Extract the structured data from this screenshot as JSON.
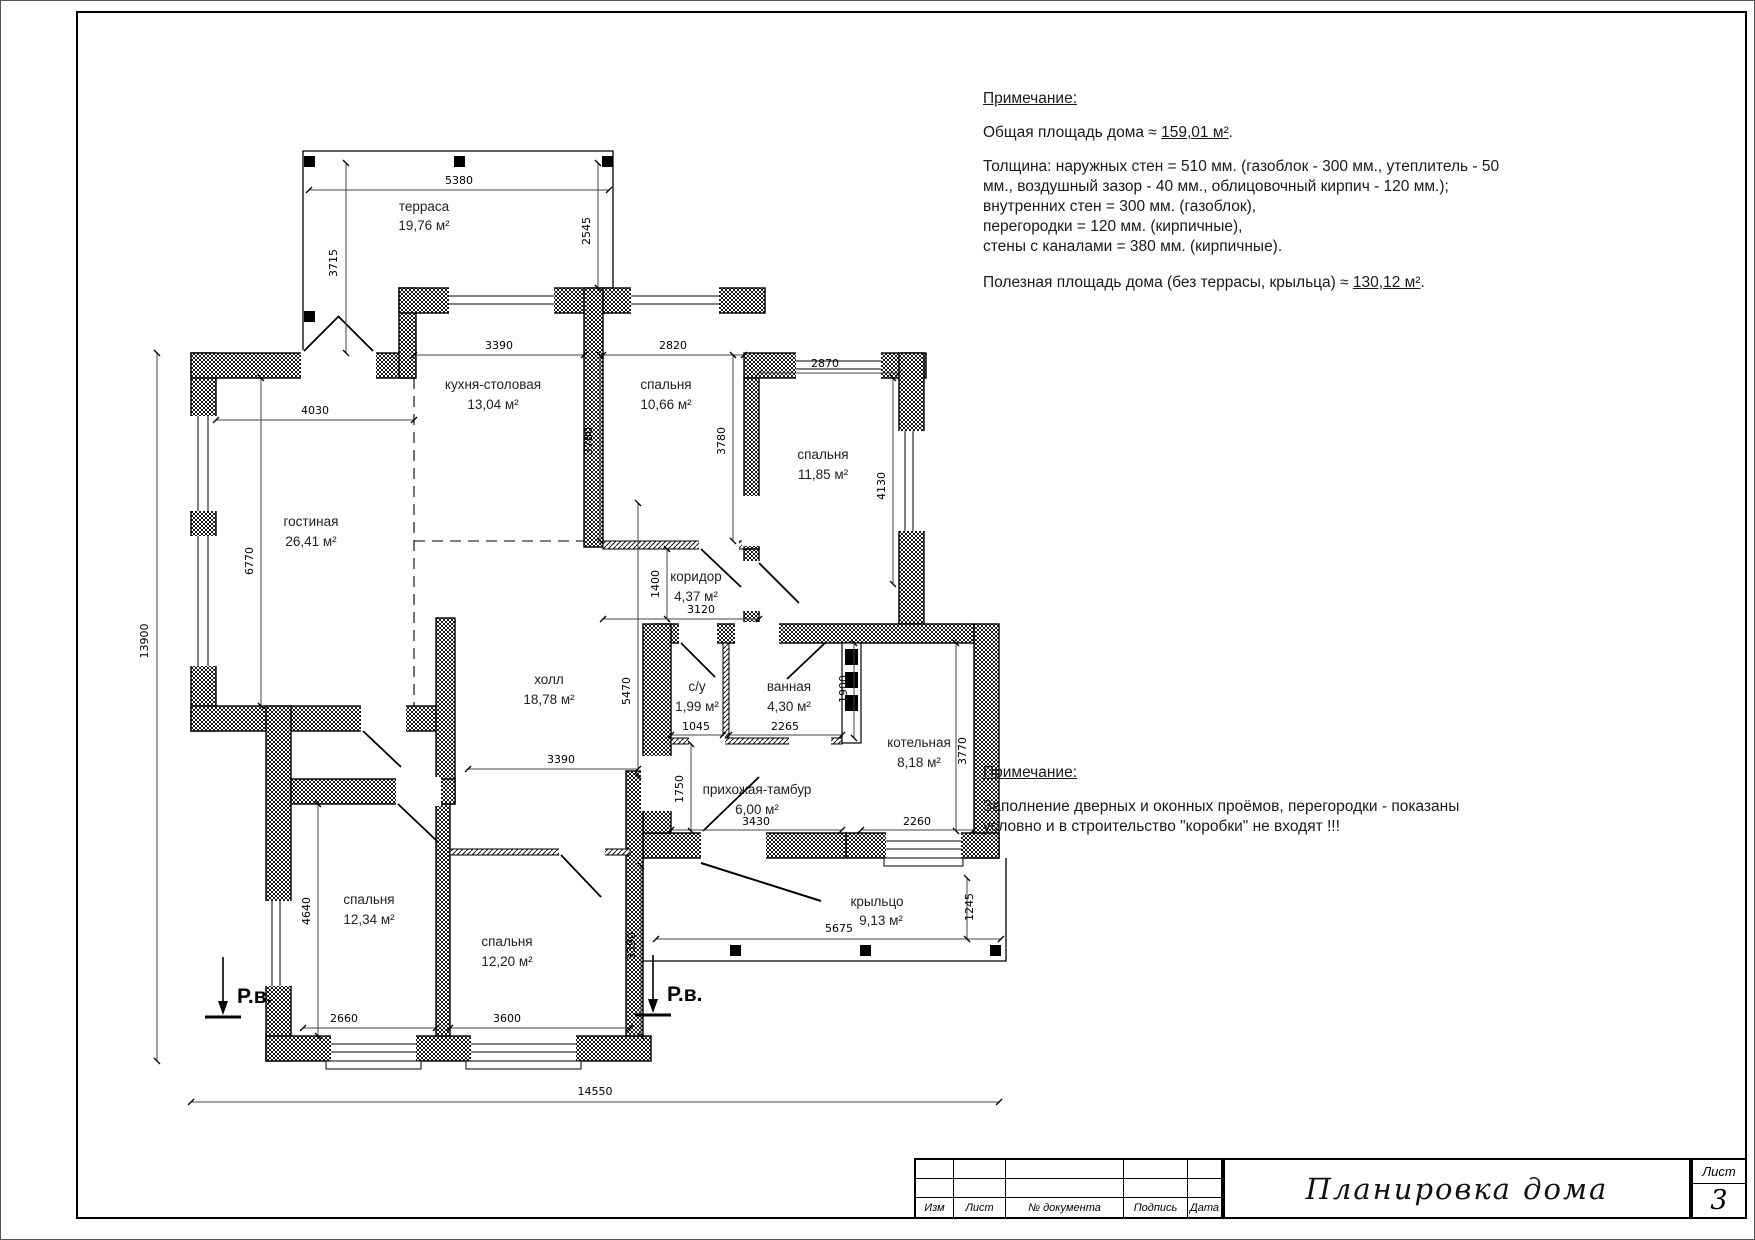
{
  "notes_top": {
    "heading": "Примечание:",
    "total_area_prefix": "Общая площадь дома ≈ ",
    "total_area_value": "159,01 м²",
    "total_area_suffix": ".",
    "thickness_lines": [
      "Толщина: наружных стен = 510 мм. (газоблок - 300 мм., утеплитель - 50",
      "мм., воздушный зазор - 40 мм., облицовочный кирпич - 120 мм.);",
      "внутренних стен = 300 мм. (газоблок),",
      "перегородки = 120 мм. (кирпичные),",
      "стены с каналами = 380 мм. (кирпичные)."
    ],
    "useful_area_prefix": "Полезная площадь дома (без террасы, крыльца) ≈ ",
    "useful_area_value": "130,12 м²",
    "useful_area_suffix": "."
  },
  "notes_mid": {
    "heading": "Примечание:",
    "body_line1": "Заполнение дверных и оконных проёмов, перегородки - показаны",
    "body_line2": "условно и в строительство \"коробки\" не входят  !!!"
  },
  "plan": {
    "rooms": [
      {
        "name": "терраса",
        "area": "19,76 м²"
      },
      {
        "name": "кухня-столовая",
        "area": "13,04 м²"
      },
      {
        "name": "спальня",
        "area": "10,66 м²"
      },
      {
        "name": "спальня",
        "area": "11,85 м²"
      },
      {
        "name": "гостиная",
        "area": "26,41 м²"
      },
      {
        "name": "коридор",
        "area": "4,37 м²"
      },
      {
        "name": "холл",
        "area": "18,78 м²"
      },
      {
        "name": "с/у",
        "area": "1,99 м²"
      },
      {
        "name": "ванная",
        "area": "4,30 м²"
      },
      {
        "name": "котельная",
        "area": "8,18 м²"
      },
      {
        "name": "прихожая-тамбур",
        "area": "6,00 м²"
      },
      {
        "name": "спальня",
        "area": "12,34 м²"
      },
      {
        "name": "спальня",
        "area": "12,20 м²"
      },
      {
        "name": "крыльцо",
        "area": "9,13 м²"
      }
    ],
    "dims": [
      "5380",
      "3715",
      "2545",
      "4030",
      "3390",
      "2820",
      "3780",
      "3780",
      "2870",
      "4130",
      "6770",
      "13900",
      "1400",
      "3120",
      "5470",
      "1045",
      "2265",
      "1900",
      "3770",
      "2260",
      "3430",
      "1750",
      "4640",
      "3390",
      "3390",
      "2660",
      "3600",
      "5675",
      "1245",
      "14550"
    ],
    "level_marker": "Р.в."
  },
  "title_block": {
    "columns": [
      "Изм",
      "Лист",
      "№ документа",
      "Подпись",
      "Дата"
    ],
    "title": "Планировка дома",
    "sheet_label": "Лист",
    "sheet_number": "3"
  }
}
